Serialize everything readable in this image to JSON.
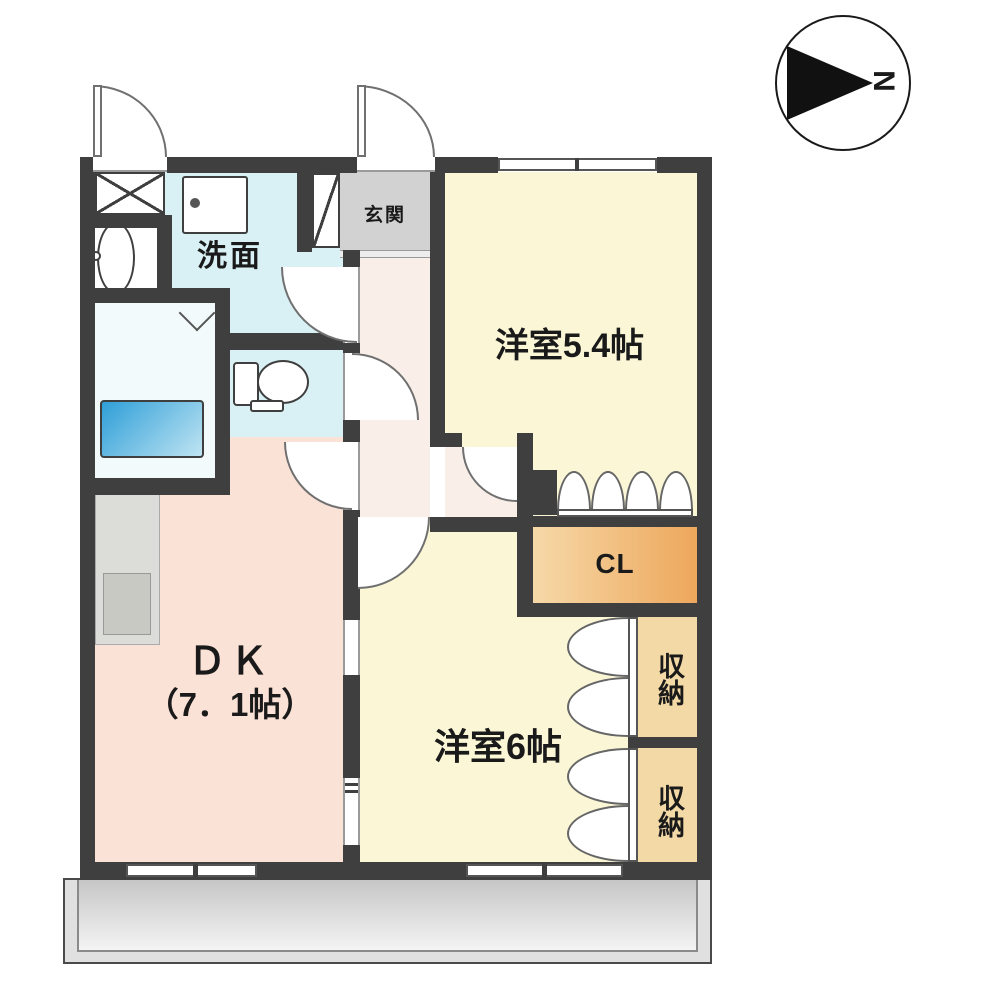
{
  "type": "apartment-floor-plan",
  "compass": {
    "north_label": "N"
  },
  "rooms": {
    "washroom": {
      "label": "洗面"
    },
    "entrance": {
      "label": "玄関"
    },
    "western_room_54": {
      "label": "洋室5.4帖"
    },
    "western_room_6": {
      "label": "洋室6帖"
    },
    "dk": {
      "label_name": "ＤＫ",
      "label_size": "（7．1帖）"
    },
    "closet": {
      "label": "CL"
    },
    "storage_upper": {
      "label": "収納"
    },
    "storage_lower": {
      "label": "収納"
    }
  },
  "fixtures": [
    "north-arrow",
    "bathtub",
    "bath-folding-door",
    "toilet",
    "wash-basin",
    "washing-machine-space",
    "oval-water-fixture",
    "shoe-cabinet",
    "kitchen-counter",
    "kitchen-sink",
    "closet-folding-doors",
    "storage-folding-doors",
    "sliding-windows",
    "balcony"
  ],
  "colors": {
    "wall": "#3f3f3f",
    "room_yellow": "#faf6d6",
    "room_pink": "#fbe2d6",
    "room_cyan": "#d9f1f4",
    "bath_white": "#f2fafc",
    "closet_orange_from": "#f6d9a8",
    "closet_orange_to": "#eda75c",
    "storage_tan": "#f3d9a6",
    "entrance_gray": "#d2d2d2",
    "hall_pink": "#f9efe8",
    "tub_blue": "#2f9fd8",
    "balcony_gray": "#c6c6c6"
  }
}
